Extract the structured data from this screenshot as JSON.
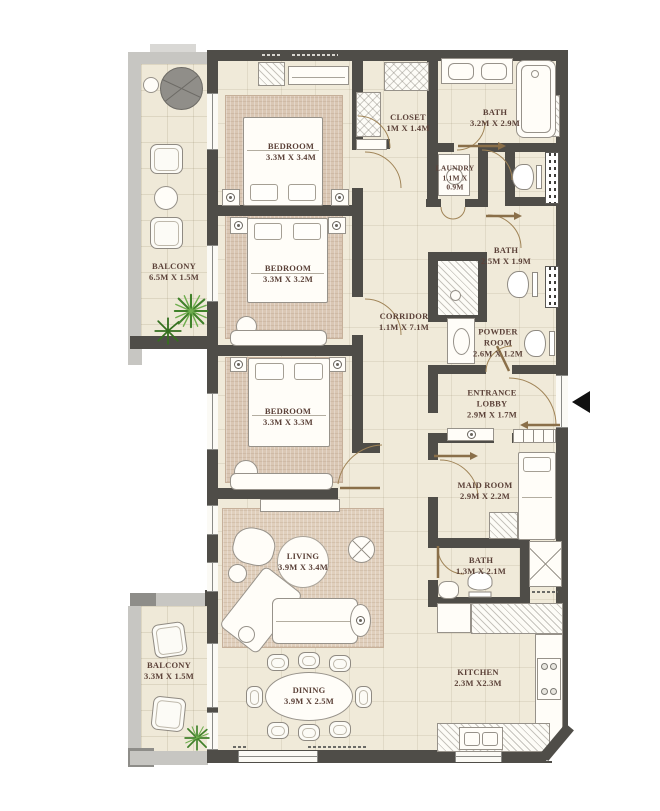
{
  "plan": {
    "type": "apartment-floor-plan",
    "rooms": [
      {
        "id": "balcony-1",
        "name": "BALCONY",
        "dims": "6.5M X 1.5M"
      },
      {
        "id": "bedroom-1",
        "name": "BEDROOM",
        "dims": "3.3M X 3.4M"
      },
      {
        "id": "bedroom-2",
        "name": "BEDROOM",
        "dims": "3.3M X 3.2M"
      },
      {
        "id": "bedroom-3",
        "name": "BEDROOM",
        "dims": "3.3M X 3.3M"
      },
      {
        "id": "closet",
        "name": "CLOSET",
        "dims": "1M X 1.4M"
      },
      {
        "id": "bath-1",
        "name": "BATH",
        "dims": "3.2M X 2.9M"
      },
      {
        "id": "laundry",
        "name": "LAUNDRY",
        "dims": "1.1M X 0.9M"
      },
      {
        "id": "bath-2",
        "name": "BATH",
        "dims": "2.5M X 1.9M"
      },
      {
        "id": "corridor",
        "name": "CORRIDOR",
        "dims": "1.1M X 7.1M"
      },
      {
        "id": "powder-room",
        "name": "POWDER ROOM",
        "dims": "2.6M X 1.2M"
      },
      {
        "id": "entrance-lobby",
        "name": "ENTRANCE LOBBY",
        "dims": "2.9M X 1.7M"
      },
      {
        "id": "maid-room",
        "name": "MAID ROOM",
        "dims": "2.9M X 2.2M"
      },
      {
        "id": "bath-3",
        "name": "BATH",
        "dims": "1.3M X 2.1M"
      },
      {
        "id": "living",
        "name": "LIVING",
        "dims": "3.9M X 3.4M"
      },
      {
        "id": "dining",
        "name": "DINING",
        "dims": "3.9M X 2.5M"
      },
      {
        "id": "kitchen",
        "name": "KITCHEN",
        "dims": "2.3M X2.3M"
      },
      {
        "id": "balcony-2",
        "name": "BALCONY",
        "dims": "3.3M X 1.5M"
      }
    ],
    "colors": {
      "wall": "#4f4d48",
      "floor": "#f0ead9",
      "rug": "#dac7b4",
      "label_text": "#5b4138",
      "balcony_rail": "#c7c6c2",
      "plant_green": "#40812a",
      "door_swing": "#a08457",
      "entrance_marker": "#111111"
    }
  }
}
